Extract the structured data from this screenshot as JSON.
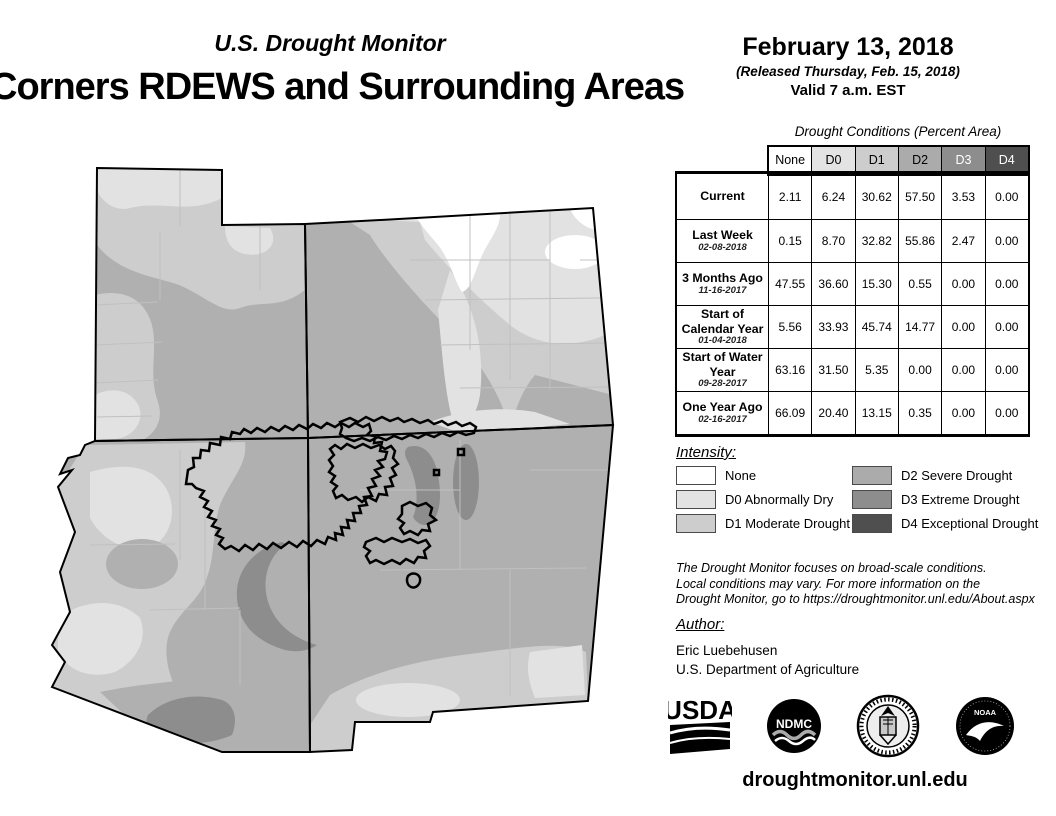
{
  "header": {
    "monitor_title": "U.S. Drought Monitor",
    "map_title": "Corners RDEWS and Surrounding Areas",
    "date": "February 13, 2018",
    "released": "(Released Thursday, Feb. 15, 2018)",
    "valid": "Valid 7 a.m. EST"
  },
  "table": {
    "caption": "Drought Conditions (Percent Area)",
    "columns": [
      {
        "label": "None",
        "bg": "#ffffff",
        "fg": "#000000"
      },
      {
        "label": "D0",
        "bg": "#e3e3e3",
        "fg": "#000000"
      },
      {
        "label": "D1",
        "bg": "#cdcdcd",
        "fg": "#000000"
      },
      {
        "label": "D2",
        "bg": "#ababab",
        "fg": "#000000"
      },
      {
        "label": "D3",
        "bg": "#8d8d8d",
        "fg": "#ffffff"
      },
      {
        "label": "D4",
        "bg": "#4f4f4f",
        "fg": "#ffffff"
      }
    ],
    "rows": [
      {
        "label": "Current",
        "date": "",
        "values": [
          "2.11",
          "6.24",
          "30.62",
          "57.50",
          "3.53",
          "0.00"
        ]
      },
      {
        "label": "Last Week",
        "date": "02-08-2018",
        "values": [
          "0.15",
          "8.70",
          "32.82",
          "55.86",
          "2.47",
          "0.00"
        ]
      },
      {
        "label": "3 Months Ago",
        "date": "11-16-2017",
        "values": [
          "47.55",
          "36.60",
          "15.30",
          "0.55",
          "0.00",
          "0.00"
        ]
      },
      {
        "label": "Start of Calendar Year",
        "date": "01-04-2018",
        "values": [
          "5.56",
          "33.93",
          "45.74",
          "14.77",
          "0.00",
          "0.00"
        ]
      },
      {
        "label": "Start of Water Year",
        "date": "09-28-2017",
        "values": [
          "63.16",
          "31.50",
          "5.35",
          "0.00",
          "0.00",
          "0.00"
        ]
      },
      {
        "label": "One Year Ago",
        "date": "02-16-2017",
        "values": [
          "66.09",
          "20.40",
          "13.15",
          "0.35",
          "0.00",
          "0.00"
        ]
      }
    ]
  },
  "legend": {
    "title": "Intensity:",
    "items": [
      {
        "label": "None",
        "color": "#ffffff"
      },
      {
        "label": "D0 Abnormally Dry",
        "color": "#e3e3e3"
      },
      {
        "label": "D1 Moderate Drought",
        "color": "#cdcdcd"
      },
      {
        "label": "D2 Severe Drought",
        "color": "#ababab"
      },
      {
        "label": "D3 Extreme Drought",
        "color": "#8d8d8d"
      },
      {
        "label": "D4 Exceptional Drought",
        "color": "#4f4f4f"
      }
    ]
  },
  "disclaimer": {
    "line1": "The Drought Monitor focuses on broad-scale conditions.",
    "line2": "Local conditions may vary. For more information on the",
    "line3": "Drought Monitor, go to https://droughtmonitor.unl.edu/About.aspx"
  },
  "author": {
    "title": "Author:",
    "name": "Eric Luebehusen",
    "org": "U.S. Department of Agriculture"
  },
  "logos": {
    "usda": "USDA",
    "ndmc": "NDMC",
    "noaa": "NOAA"
  },
  "footer": {
    "url": "droughtmonitor.unl.edu"
  }
}
